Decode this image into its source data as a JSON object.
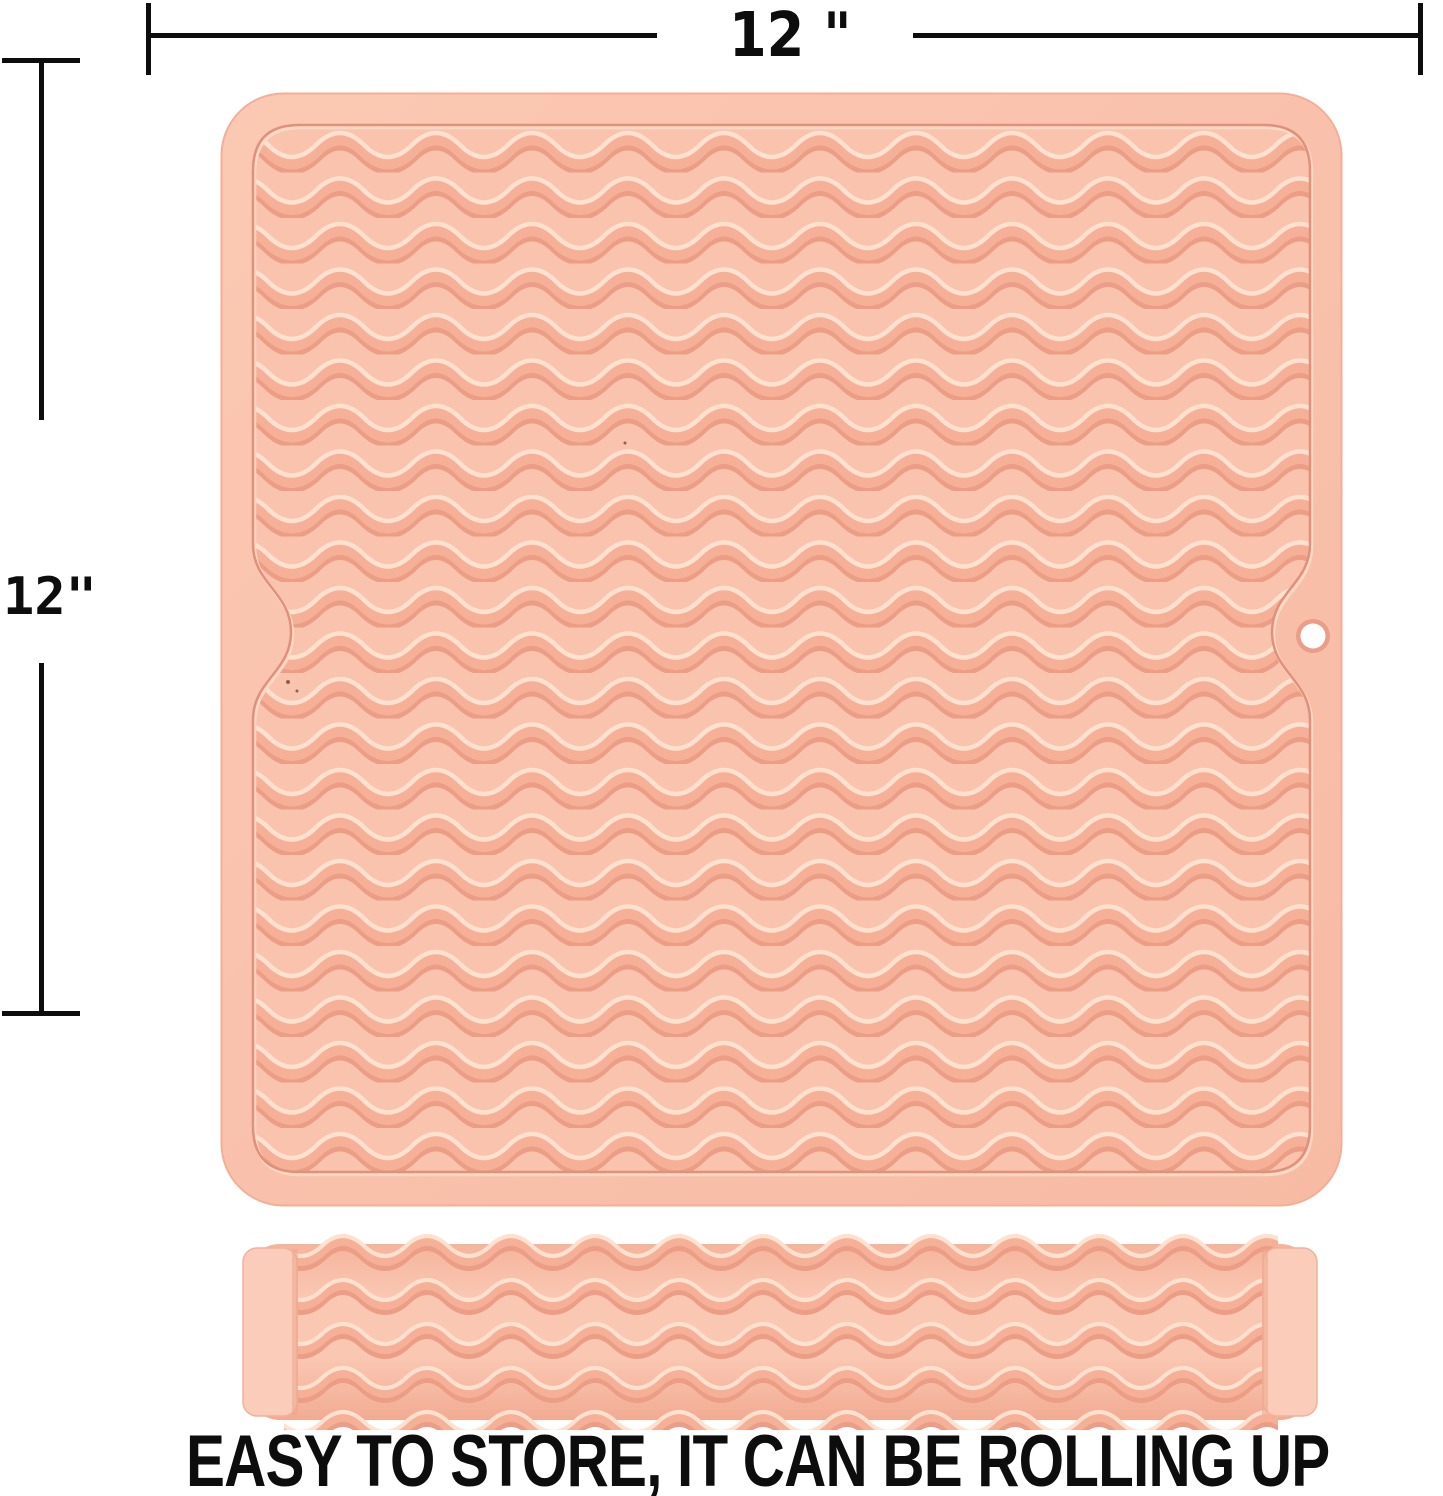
{
  "page": {
    "background_color": "#ffffff"
  },
  "annotations": {
    "width_dimension": {
      "label": "12 \""
    },
    "height_dimension": {
      "label": "12\""
    },
    "line_color": "#0d0d0d"
  },
  "caption": {
    "text": "EASY TO STORE, IT CAN BE ROLLING UP",
    "color": "#0d0d0d"
  },
  "product": {
    "items": [
      "flat-drying-mat",
      "rolled-drying-mat"
    ],
    "colors": {
      "mat_base": "#f9c3ae",
      "rim_gradient_light": "#fbc9b3",
      "rim_gradient_dark": "#f7bba4",
      "ridge_highlight": "#ffe1d0",
      "ridge_mid": "#f5b097",
      "ridge_shadow": "#eb9e85",
      "groove_line": "#e1907a",
      "groove_light": "#ffd8c6",
      "end_cap": "#fbccb9",
      "hole_ring": "#ea9d88",
      "hole_fill": "#ffffff"
    }
  }
}
